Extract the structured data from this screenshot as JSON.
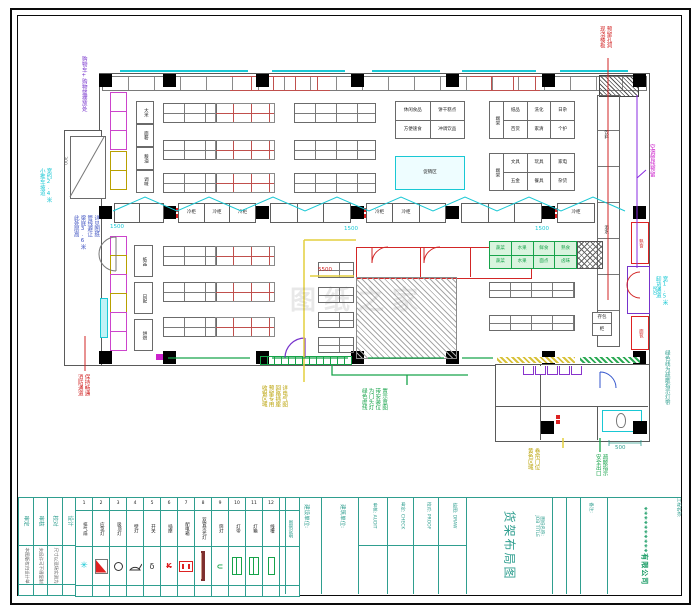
{
  "sheet": {
    "company": "**********有限公司",
    "project_label": "工程名称:",
    "job_title_label": "图纸名称:",
    "job_title_en": "JOB TITLE",
    "drawing_title": "货架布局图",
    "note_label": "备注:"
  },
  "titleblock": {
    "left_cols": [
      "审定",
      "审核",
      "校对",
      "设计"
    ],
    "left_notes": [
      "本图版权归设计单位所有",
      "未经许可不得复制翻印",
      "尺寸以现场实测为准"
    ],
    "mid_cols": [
      "建设单位:",
      "建筑单位:",
      "审核: AUDIT",
      "审定: CHECK",
      "校对: PROOF",
      "绘图: DRAW"
    ]
  },
  "legend": {
    "items": [
      {
        "no": "1",
        "name": "排气扇"
      },
      {
        "no": "2",
        "name": "应急灯"
      },
      {
        "no": "3",
        "name": "吸顶灯"
      },
      {
        "no": "4",
        "name": "壁灯"
      },
      {
        "no": "5",
        "name": "开关"
      },
      {
        "no": "6",
        "name": "插座"
      },
      {
        "no": "7",
        "name": "配电箱"
      },
      {
        "no": "8",
        "name": "双管荧光灯"
      },
      {
        "no": "9",
        "name": "筒灯"
      },
      {
        "no": "10",
        "name": "灯带"
      },
      {
        "no": "11",
        "name": "灯箱"
      },
      {
        "no": "12",
        "name": "线槽"
      }
    ],
    "tail": "图例说明"
  },
  "fixtures": {
    "freezer": "冷柜",
    "left_labels": [
      "大米",
      "面粉",
      "粮油",
      "调味"
    ],
    "left_labels2": [
      "纸品",
      "日配",
      "烘焙"
    ],
    "t1": [
      "休闲食品",
      "饼干糕点",
      "方便速食",
      "冲调饮品"
    ],
    "promo": "促销区",
    "end_cap": "端架",
    "t3": [
      "纸品",
      "洗化",
      "日杂",
      "百货",
      "家清",
      "个护"
    ],
    "t4": [
      "文具",
      "玩具",
      "家电",
      "五金",
      "餐具",
      "杂货"
    ],
    "tall_shelf": [
      "饮料",
      "酒水"
    ],
    "green_cells": [
      "蔬菜",
      "水果",
      "鲜食",
      "熟食",
      "蔬菜",
      "水果",
      "面点",
      "卤味"
    ],
    "wall_freezers": [
      "熟食",
      "面包"
    ],
    "locker": [
      "存包",
      "柜"
    ]
  },
  "dims": {
    "d1500": "1500",
    "d5500": "5500",
    "d500": "500",
    "d850": "850",
    "d300": "300"
  },
  "annotations": {
    "cart": "购物车+购物篮摆放处",
    "ramp1": "小推车坡道",
    "ramp2": "宽约2.4米",
    "blue": [
      "此处层高",
      "梁底3.6米",
      "管线避让",
      "详见图纸"
    ],
    "fire1": "消防通道",
    "fire2": "保持畅通",
    "slab1": "现浇楼板",
    "slab2": "预留孔洞",
    "ac": "空调管线预留",
    "unload1": "卸货通道",
    "unload2": "宽1.5米",
    "evac": "绿色线为疏散指示灯带",
    "cashier": [
      "收银区域",
      "预留专用",
      "回路插座",
      "详电气图"
    ],
    "doorhead": [
      "绿色虚线",
      "为门头灯",
      "带安装位",
      "置示意图"
    ],
    "shutter1": "黄色区域",
    "shutter2": "卷帘门位",
    "exit1": "安全出口",
    "exit2": "疏散指示"
  },
  "watermark": "图纸之家"
}
